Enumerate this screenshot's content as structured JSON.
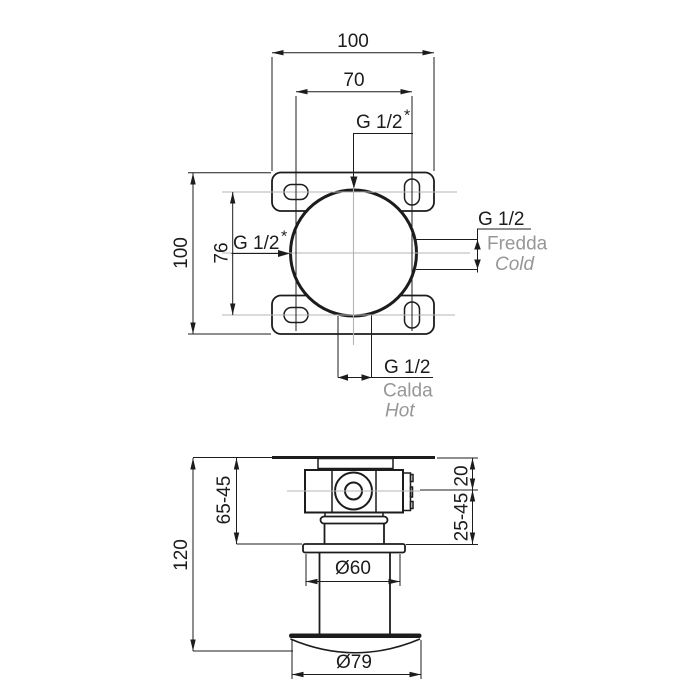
{
  "colors": {
    "line": "#1c1c1c",
    "centerline": "#b4b4b4",
    "label_gray": "#979797",
    "bg": "#ffffff"
  },
  "top_view": {
    "dim_plate_width": "100",
    "dim_hole_spacing_h": "70",
    "dim_plate_height": "100",
    "dim_hole_spacing_v": "76",
    "outlet_top": {
      "size": "G 1/2",
      "star": "*"
    },
    "inlet_left": {
      "size": "G 1/2",
      "star": "*"
    },
    "cold_port": {
      "size": "G 1/2",
      "name_it": "Fredda",
      "name_en": "Cold"
    },
    "hot_port": {
      "size": "G 1/2",
      "name_it": "Calda",
      "name_en": "Hot"
    }
  },
  "side_view": {
    "dim_total_depth": "120",
    "dim_rough_in_depth": "65-45",
    "dim_plate_offset": "20",
    "dim_adjustment_range": "25-45",
    "dim_flange_diameter": "Ø60",
    "dim_escutcheon_diameter": "Ø79"
  }
}
